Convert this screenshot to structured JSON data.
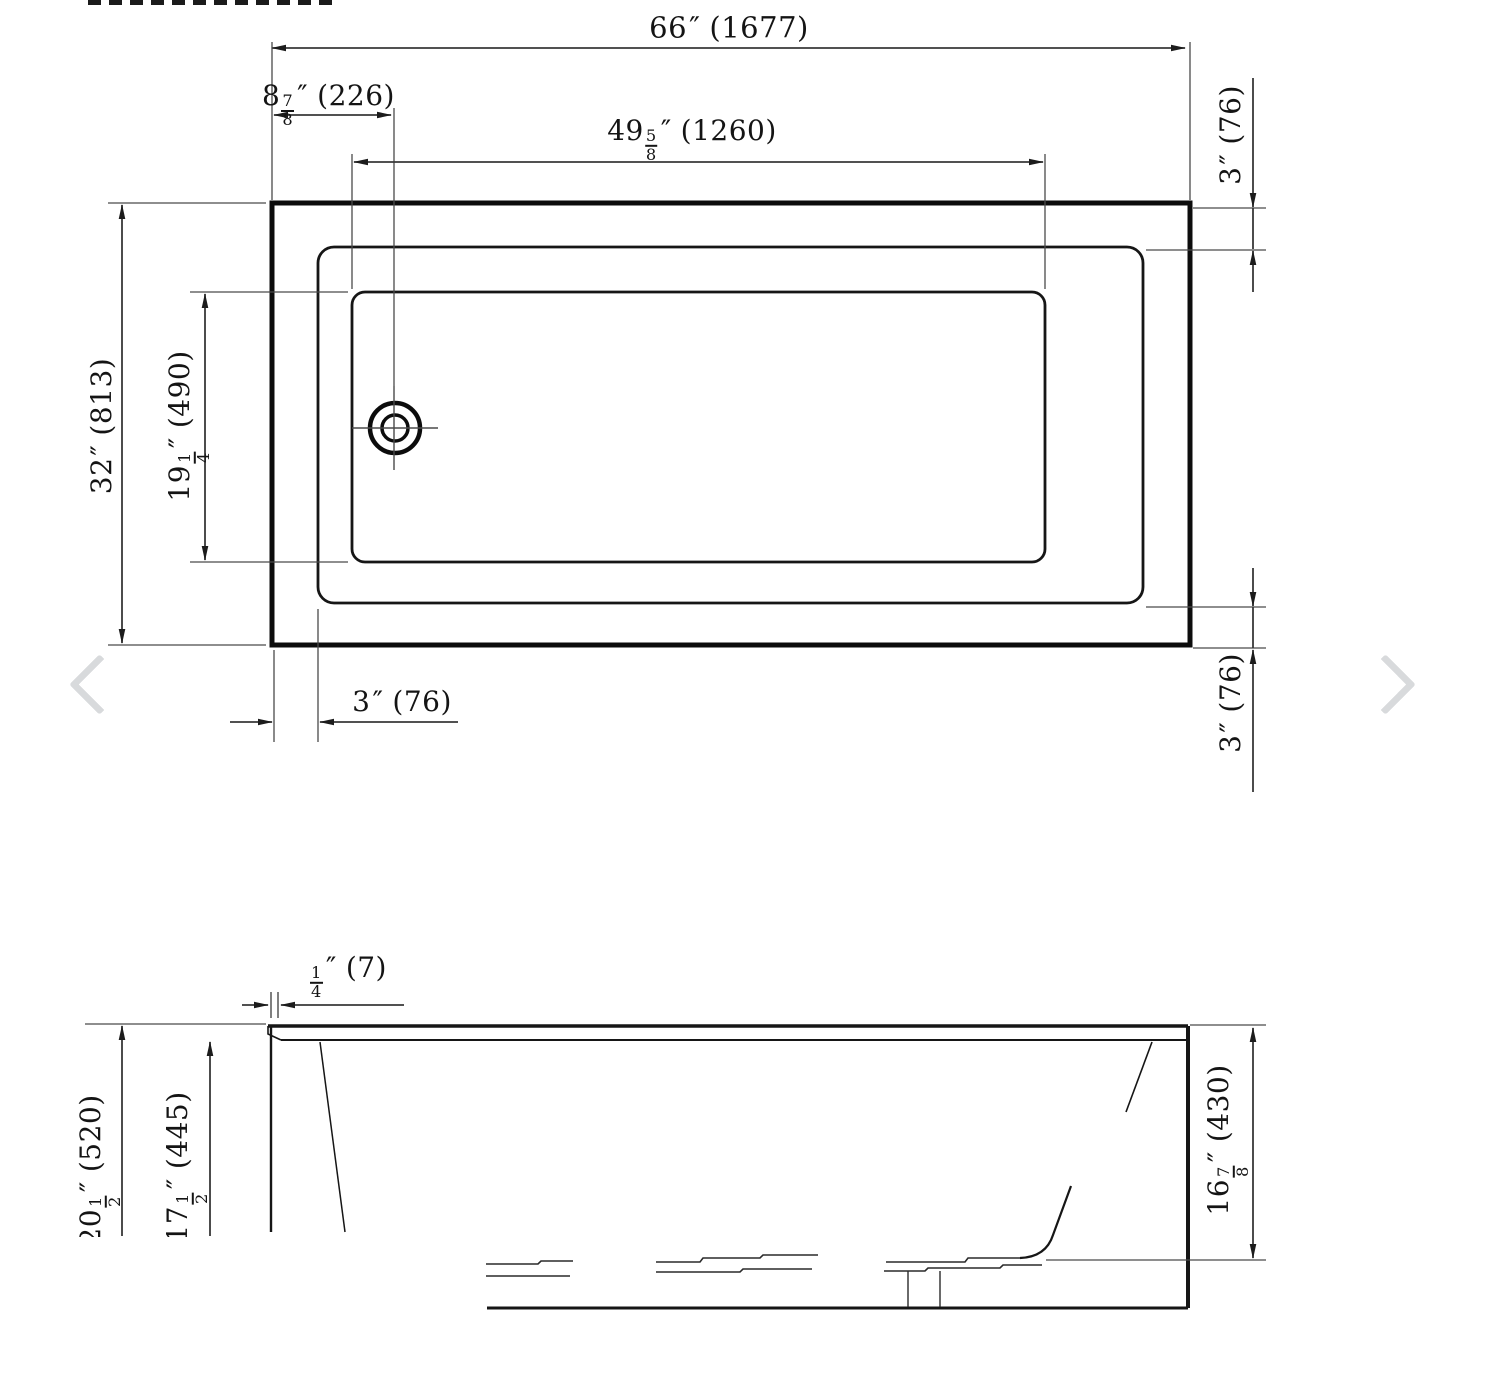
{
  "image": {
    "background": "#ffffff"
  },
  "carousel": {
    "prev_icon": "chevron-left-icon",
    "next_icon": "chevron-right-icon",
    "arrow_color": "#d8dadc"
  },
  "drawing": {
    "type": "bathtub-dimension-drawing",
    "views": [
      "top-view",
      "side-view"
    ],
    "line_color": "#111111",
    "dim_line_color": "#383838"
  },
  "dimensions": {
    "overall_length": {
      "whole": "66",
      "unit": "″",
      "mm": "(1677)"
    },
    "drain_offset": {
      "whole": "8",
      "num": "7",
      "den": "8",
      "unit": "″",
      "mm": "(226)"
    },
    "basin_length": {
      "whole": "49",
      "num": "5",
      "den": "8",
      "unit": "″",
      "mm": "(1260)"
    },
    "rim_top_right": {
      "whole": "3",
      "unit": "″",
      "mm": "(76)"
    },
    "overall_width": {
      "whole": "32",
      "unit": "″",
      "mm": "(813)"
    },
    "basin_width": {
      "whole": "19",
      "num": "1",
      "den": "4",
      "unit": "″",
      "mm": "(490)"
    },
    "rim_bottom_left": {
      "whole": "3",
      "unit": "″",
      "mm": "(76)"
    },
    "rim_bottom_right": {
      "whole": "3",
      "unit": "″",
      "mm": "(76)"
    },
    "lip_thickness": {
      "num": "1",
      "den": "4",
      "unit": "″",
      "mm": "(7)"
    },
    "overall_height": {
      "whole": "20",
      "num": "1",
      "den": "2",
      "unit": "″",
      "mm": "(520)"
    },
    "interior_depth": {
      "whole": "17",
      "num": "1",
      "den": "2",
      "unit": "″",
      "mm": "(445)"
    },
    "depth_to_seat": {
      "whole": "16",
      "num": "7",
      "den": "8",
      "unit": "″",
      "mm": "(430)"
    }
  }
}
